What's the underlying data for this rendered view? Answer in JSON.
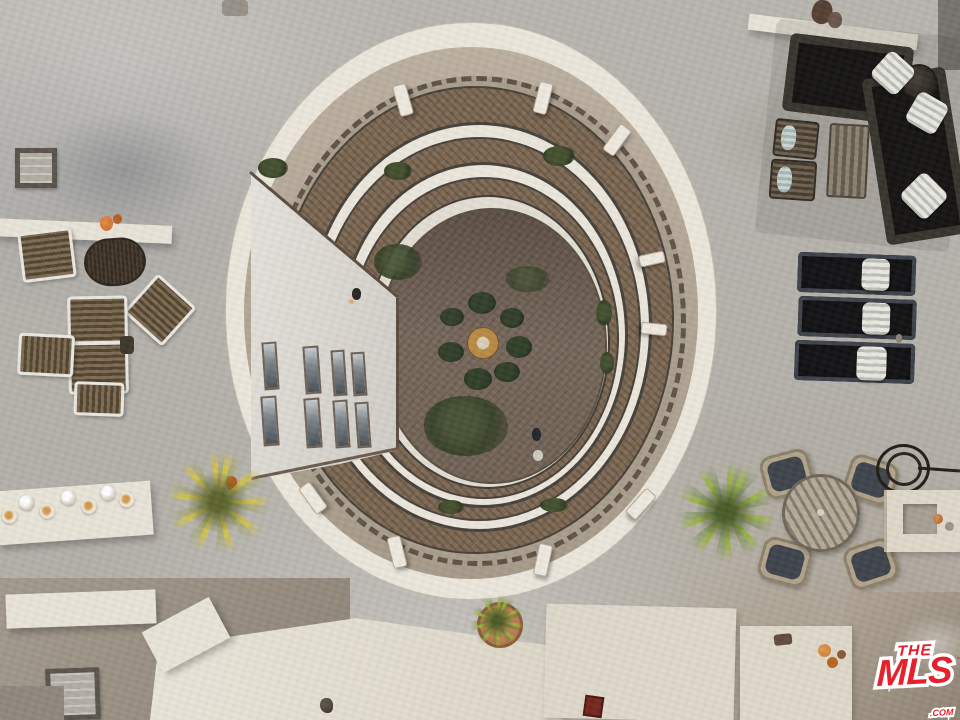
{
  "watermark": {
    "the": "THE",
    "mls": "MLS",
    "com": ".COM",
    "tm": "™"
  },
  "palette": {
    "concrete": "#b6b2ab",
    "concrete_dark": "#9fa09f",
    "parapet_white": "#ece7dc",
    "roof_tan": "#b3a796",
    "tile_brown": "#7c6751",
    "rail_dark": "#46413a",
    "floor_brown": "#7d6d60",
    "wall_white": "#e2dfd8",
    "foliage_dark": "#3a4629",
    "palm_yellow": "#cdbe46",
    "palm_green": "#96ae3c",
    "cushion_black": "#17171a",
    "sofa_frame": "#38342e",
    "pillow_white": "#eae8e1",
    "wicker_tan": "#b2a48c",
    "seat_gray": "#3f444c",
    "wood_slat": "#6e604e",
    "terracotta": "#c08455",
    "brand_red": "#e5212b"
  }
}
